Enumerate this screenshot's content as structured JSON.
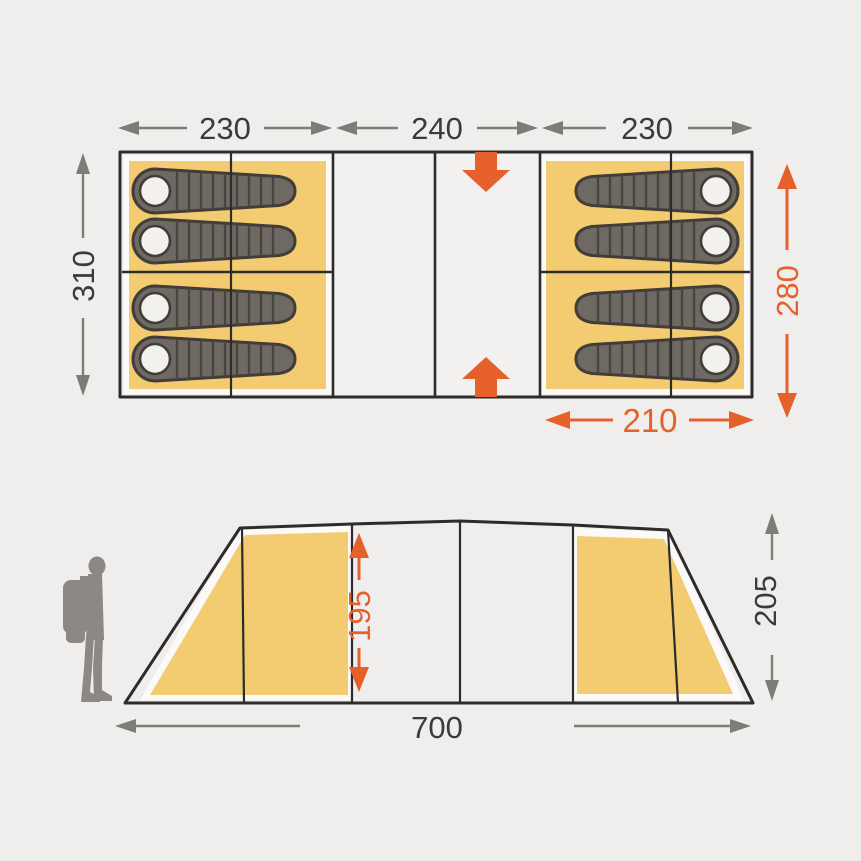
{
  "diagram": {
    "title": "tent-dimensions-diagram",
    "floor_plan": {
      "left_width": "230",
      "center_width": "240",
      "right_width": "230",
      "total_depth": "310",
      "inner_depth": "280",
      "bedroom_width": "210"
    },
    "side_view": {
      "inner_height": "195",
      "outer_height": "205",
      "total_length": "700"
    },
    "icons": {
      "sleeping_bag": "sleeping-bag-icon",
      "hiker": "hiker-icon",
      "entrance_top": "entrance-arrow-down-icon",
      "entrance_bottom": "entrance-arrow-up-icon"
    },
    "colors": {
      "bg": "#EFEEEC",
      "panel": "#F2F1EF",
      "yellow": "#F3CC72",
      "white": "#FBFAF9",
      "line": "#2D2C2A",
      "dim": "#7D7C79",
      "text": "#3B3B3A",
      "accent": "#E5602B",
      "bagbody": "#6E6963",
      "bagdark": "#423D38",
      "bagrib": "#49443F",
      "pillow": "#F3F1EE",
      "person": "#8B8886"
    }
  }
}
